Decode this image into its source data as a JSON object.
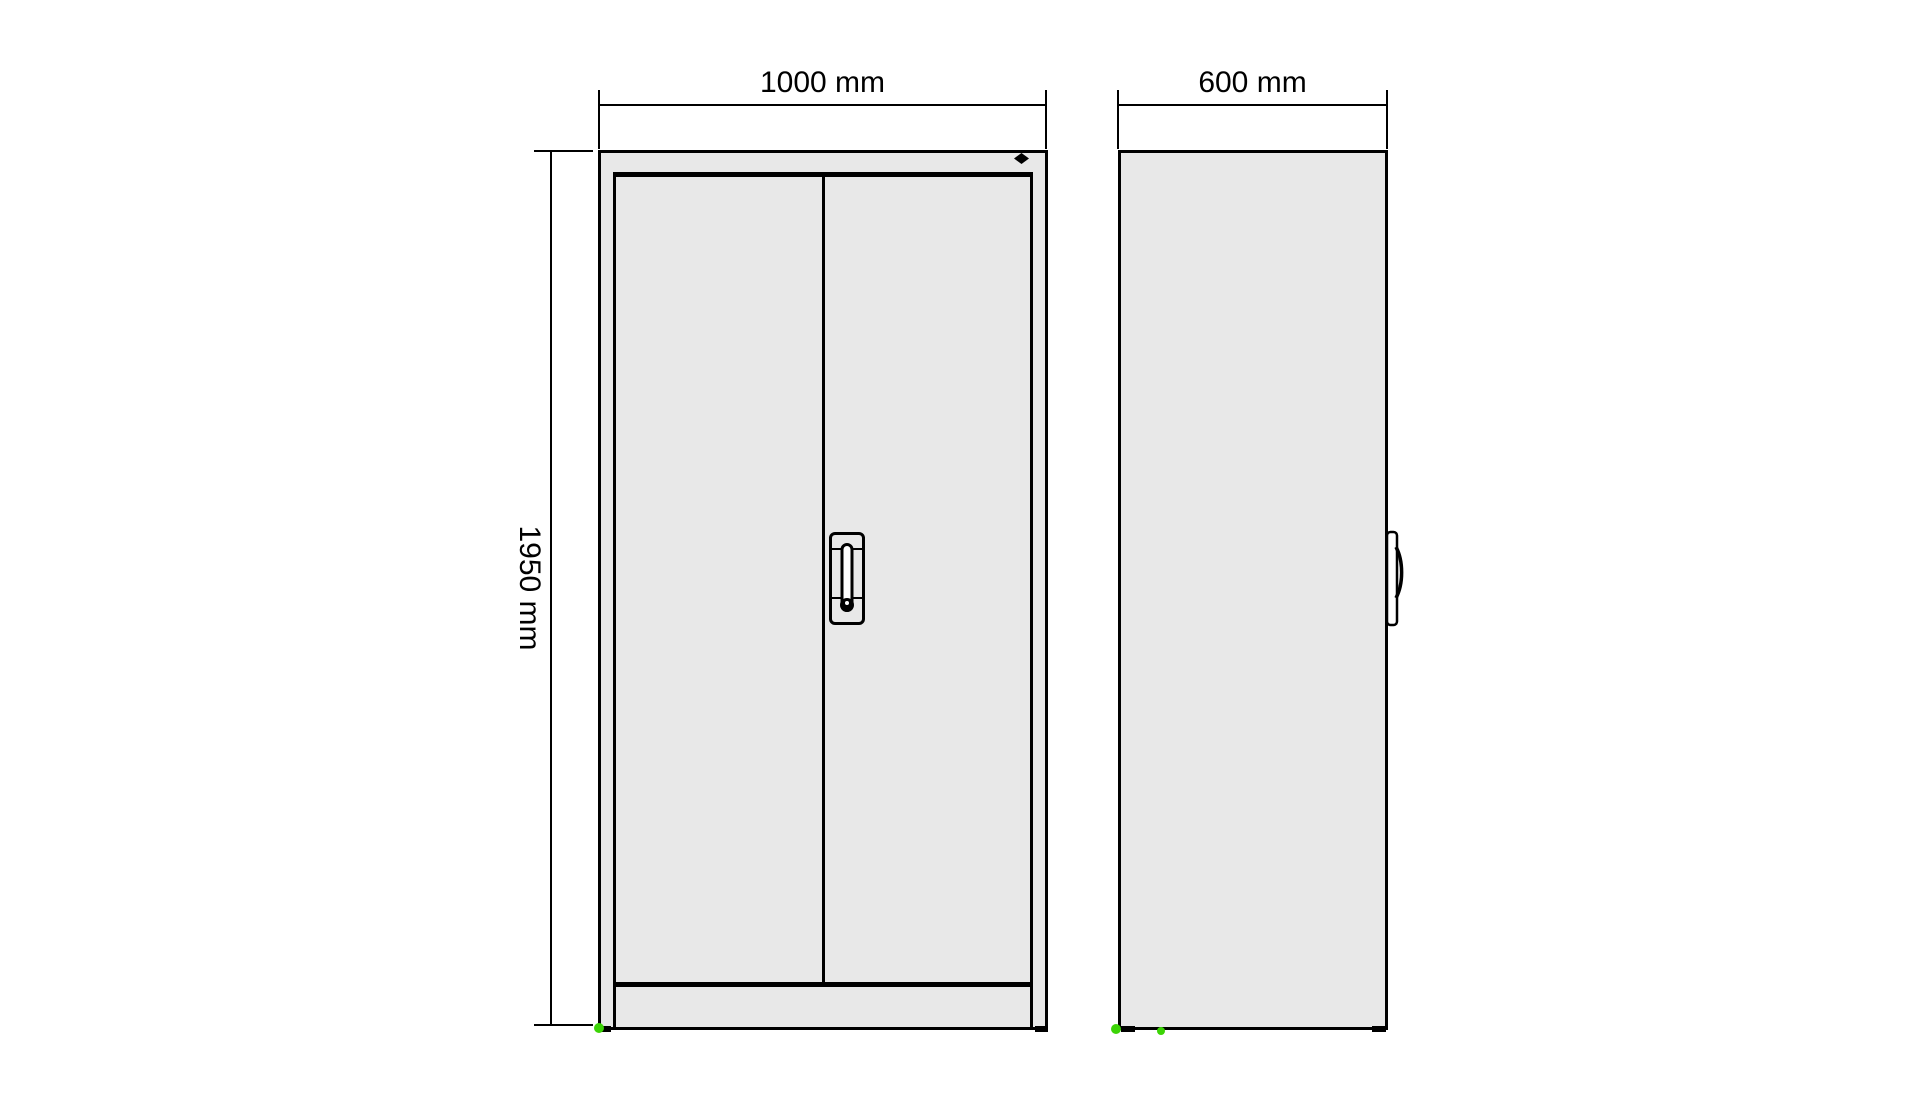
{
  "dimensions": {
    "front_width": "1000 mm",
    "side_depth": "600 mm",
    "height": "1950 mm"
  },
  "colors": {
    "line": "#000000",
    "panel-fill": "#e8e8e8",
    "marker-green": "#3cd406",
    "background": "#ffffff"
  },
  "icons": {
    "lock": "lock-diamond-icon",
    "keyhole": "keyhole-icon",
    "front_handle": "door-handle",
    "side_handle": "door-handle-profile-icon"
  }
}
